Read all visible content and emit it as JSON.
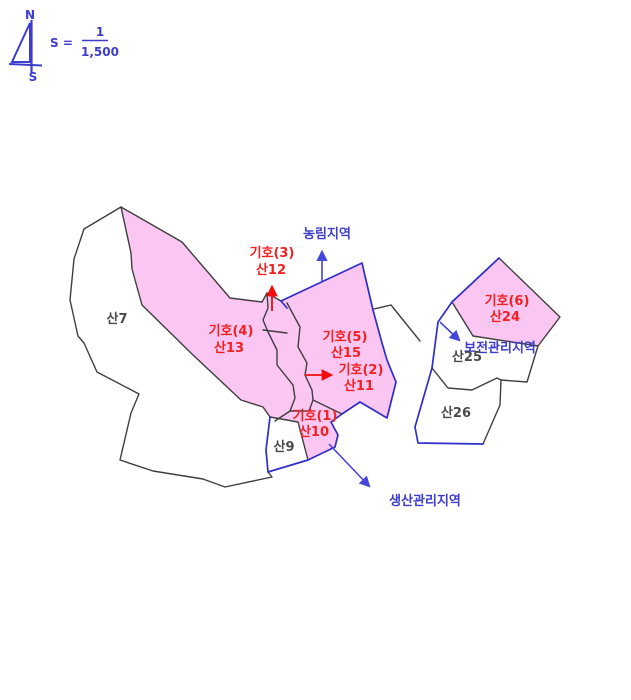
{
  "compass": {
    "north": "N",
    "south": "S"
  },
  "scale": {
    "label": "S =",
    "numerator": "1",
    "denominator": "1,500"
  },
  "zones": {
    "agriculture": "농림지역",
    "conservation": "보전관리지역",
    "production": "생산관리지역"
  },
  "parcels": {
    "san7": {
      "name": "산7"
    },
    "san9": {
      "name": "산9"
    },
    "san10": {
      "symbol": "기호(1)",
      "name": "산10"
    },
    "san11": {
      "symbol": "기호(2)",
      "name": "산11"
    },
    "san12": {
      "symbol": "기호(3)",
      "name": "산12"
    },
    "san13": {
      "symbol": "기호(4)",
      "name": "산13"
    },
    "san15": {
      "symbol": "기호(5)",
      "name": "산15"
    },
    "san24": {
      "symbol": "기호(6)",
      "name": "산24"
    },
    "san25": {
      "name": "산25"
    },
    "san26": {
      "name": "산26"
    }
  },
  "colors": {
    "parcel_fill": "#fbc6f2",
    "boundary_line": "#3f3f3f",
    "zone_boundary_blue": "#2e2ec8",
    "symbol_red": "#f22020",
    "zone_label_blue": "#3c3ccd",
    "parcel_label": "#4a4a4a"
  }
}
